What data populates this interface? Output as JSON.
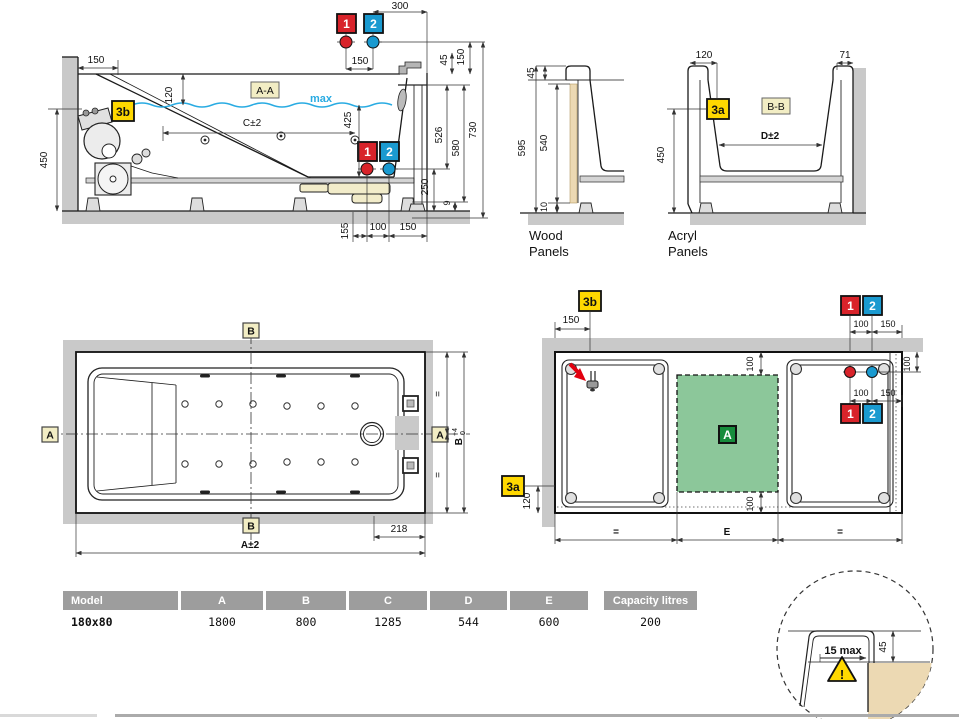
{
  "colors": {
    "red_marker": "#d8232a",
    "blue_marker": "#1a9ad0",
    "yellow_marker": "#ffd800",
    "pale_yellow_label": "#f2edc4",
    "green_area": "#8cc79a",
    "green_marker": "#178c3c",
    "water": "#29abe2",
    "wall_gray": "#c9c9c9",
    "wood_tan": "#ecd9b3",
    "table_header_gray": "#9d9d9d"
  },
  "dims": {
    "d9": "9",
    "d10": "10",
    "d45": "45",
    "d71": "71",
    "d100": "100",
    "d120": "120",
    "d150": "150",
    "d155": "155",
    "d218": "218",
    "d250": "250",
    "d300": "300",
    "d425": "425",
    "d450": "450",
    "d526": "526",
    "d540": "540",
    "d580": "580",
    "d595": "595",
    "d730": "730",
    "c": "C±2",
    "d": "D±2",
    "a": "A±2",
    "b": "B",
    "b_sup": "+4",
    "b_sub": "0",
    "eq": "=",
    "e": "E",
    "max": "max"
  },
  "markers": {
    "m1": "1",
    "m2": "2",
    "m3a": "3a",
    "m3b": "3b",
    "a": "A",
    "b": "B",
    "aa": "A-A",
    "bb": "B-B"
  },
  "panels": {
    "wood_line1": "Wood",
    "wood_line2": "Panels",
    "acryl_line1": "Acryl",
    "acryl_line2": "Panels"
  },
  "table": {
    "headers": [
      "Model",
      "A",
      "B",
      "C",
      "D",
      "E",
      "Capacity litres"
    ],
    "row": [
      "180x80",
      "1800",
      "800",
      "1285",
      "544",
      "600",
      "200"
    ]
  },
  "detail": {
    "dim_15max": "15 max",
    "warning": "!"
  }
}
